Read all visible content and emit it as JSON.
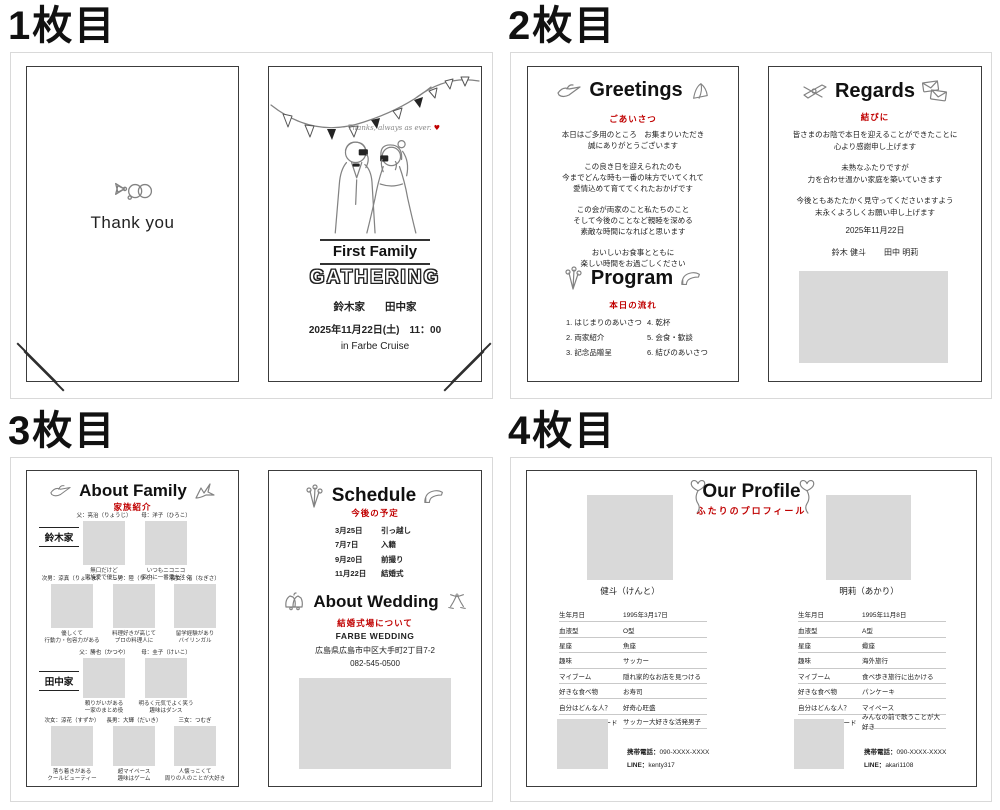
{
  "colors": {
    "accent_red": "#c00000",
    "placeholder_gray": "#d9d9d9",
    "ink": "#222222"
  },
  "page1": {
    "heading": "1枚目",
    "back": {
      "thank_you": "Thank you"
    },
    "cover": {
      "script_text": "Thanks, always as ever.",
      "heart": "♥",
      "title_line1": "First Family",
      "title_line2": "GATHERING",
      "family_left": "鈴木家",
      "family_right": "田中家",
      "datetime": "2025年11月22日(土)　11：00",
      "venue": "in Farbe Cruise"
    }
  },
  "page2": {
    "heading": "2枚目",
    "greetings": {
      "title": "Greetings",
      "subtitle": "ごあいさつ",
      "paragraphs": [
        [
          "本日はご多用のところ　お集まりいただき",
          "誠にありがとうございます"
        ],
        [
          "この良き日を迎えられたのも",
          "今までどんな時も一番の味方でいてくれて",
          "愛情込めて育ててくれたおかげです"
        ],
        [
          "この会が両家のこと私たちのこと",
          "そして今後のことなど親睦を深める",
          "素敵な時間になればと思います"
        ],
        [
          "おいしいお食事とともに",
          "楽しい時間をお過ごしください"
        ]
      ]
    },
    "program": {
      "title": "Program",
      "subtitle": "本日の流れ",
      "left_items": [
        "1. はじまりのあいさつ",
        "2. 両家紹介",
        "3. 記念品贈呈"
      ],
      "right_items": [
        "4. 乾杯",
        "5. 会食・歓談",
        "6. 結びのあいさつ"
      ]
    },
    "regards": {
      "title": "Regards",
      "subtitle": "結びに",
      "paragraphs": [
        [
          "皆さまのお陰で本日を迎えることができたことに",
          "心より感謝申し上げます"
        ],
        [
          "未熟なふたりですが",
          "力を合わせ温かい家庭を築いていきます"
        ],
        [
          "今後ともあたたかく見守ってくださいますよう",
          "末永くよろしくお願い申し上げます"
        ]
      ],
      "date": "2025年11月22日",
      "groom_name": "鈴木 健斗",
      "bride_name": "田中 明莉"
    }
  },
  "page3": {
    "heading": "3枚目",
    "about_family": {
      "title": "About Family",
      "subtitle": "家族紹介",
      "suzuki_label": "鈴木家",
      "tanaka_label": "田中家",
      "suzuki_parents": [
        {
          "name": "父：亮治（りょうじ）",
          "cap1": "無口だけど",
          "cap2": "家族愛で優しい"
        },
        {
          "name": "母：洋子（ひろこ）",
          "cap1": "いつもニコニコ",
          "cap2": "家中に一番愛を注ぐ"
        }
      ],
      "suzuki_children": [
        {
          "name": "次男：涼真（りょうま）",
          "cap1": "優しくて",
          "cap2": "行動力・包容力がある"
        },
        {
          "name": "三男：陸（りく）",
          "cap1": "料理好きが高じて",
          "cap2": "プロの料理人に"
        },
        {
          "name": "長女：渚（なぎさ）",
          "cap1": "留学経験があり",
          "cap2": "バイリンガル"
        }
      ],
      "tanaka_parents": [
        {
          "name": "父：勝也（かつや）",
          "cap1": "頼りがいがある",
          "cap2": "一家のまとめ役"
        },
        {
          "name": "母：圭子（けいこ）",
          "cap1": "明るく元気でよく笑う",
          "cap2": "趣味はダンス"
        }
      ],
      "tanaka_children": [
        {
          "name": "次女：涼花（すずか）",
          "cap1": "落ち着きがある",
          "cap2": "クールビューティー"
        },
        {
          "name": "長男：大輝（だいき）",
          "cap1": "超マイペース",
          "cap2": "趣味はゲーム"
        },
        {
          "name": "三女：つむぎ",
          "cap1": "人懐っこくて",
          "cap2": "周りの人のことが大好き"
        }
      ]
    },
    "schedule": {
      "title": "Schedule",
      "subtitle": "今後の予定",
      "items": [
        {
          "date": "3月25日",
          "event": "引っ越し"
        },
        {
          "date": "7月7日",
          "event": "入籍"
        },
        {
          "date": "9月20日",
          "event": "前撮り"
        },
        {
          "date": "11月22日",
          "event": "結婚式"
        }
      ]
    },
    "about_wedding": {
      "title": "About Wedding",
      "subtitle": "結婚式場について",
      "venue_name": "FARBE WEDDING",
      "address": "広島県広島市中区大手町2丁目7-2",
      "phone": "082-545-0500"
    }
  },
  "page4": {
    "heading": "4枚目",
    "profile": {
      "title": "Our Profile",
      "subtitle": "ふたりのプロフィール",
      "labels": [
        "生年月日",
        "血液型",
        "星座",
        "趣味",
        "マイブーム",
        "好きな食べ物",
        "自分はどんな人？",
        "幼い頃のエピソード"
      ],
      "groom": {
        "name": "健斗（けんと）",
        "values": [
          "1995年3月17日",
          "O型",
          "魚座",
          "サッカー",
          "隠れ家的なお店を見つける",
          "お寿司",
          "好奇心旺盛",
          "サッカー大好きな活発男子"
        ],
        "phone_label": "携帯電話：",
        "phone": "090-XXXX-XXXX",
        "line_label": "LINE：",
        "line": "kenty317"
      },
      "bride": {
        "name": "明莉（あかり）",
        "values": [
          "1995年11月8日",
          "A型",
          "蠍座",
          "海外旅行",
          "食べ歩き旅行に出かける",
          "パンケーキ",
          "マイペース",
          "みんなの前で歌うことが大好き"
        ],
        "phone_label": "携帯電話：",
        "phone": "090-XXXX-XXXX",
        "line_label": "LINE：",
        "line": "akari1108"
      }
    }
  }
}
